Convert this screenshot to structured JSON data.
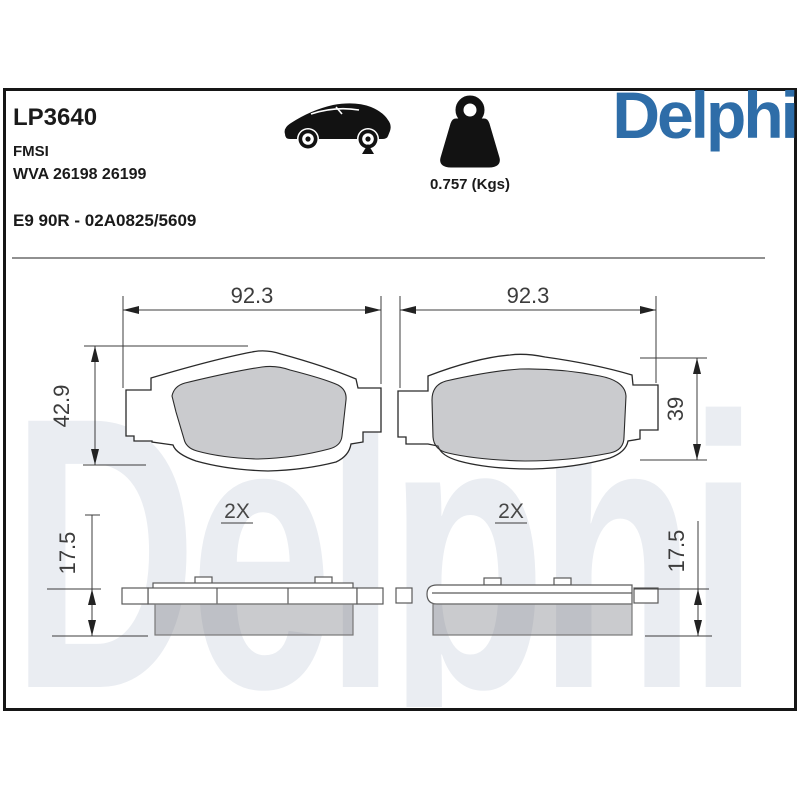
{
  "header": {
    "part_number": "LP3640",
    "fmsi_label": "FMSI",
    "wva_numbers": "WVA 26198 26199",
    "approval": "E9 90R - 02A0825/5609",
    "weight": "0.757 (Kgs)",
    "brand": "Delphi"
  },
  "watermark": "Delphi",
  "dimensions": {
    "pad1_width": "92.3",
    "pad1_height": "42.9",
    "pad1_qty": "2X",
    "pad1_thickness": "17.5",
    "pad2_width": "92.3",
    "pad2_height": "39",
    "pad2_qty": "2X",
    "pad2_thickness": "17.5"
  },
  "icons": {
    "car": "car-rear-axle-icon",
    "weight": "weight-kettlebell-icon"
  },
  "colors": {
    "brand_blue": "#2E6DA8",
    "outline_dark": "#2a2a2a",
    "dimension_gray": "#3c3c3c",
    "friction_gray": "#c9c9c9",
    "watermark_gray": "#eaedf2",
    "frame_black": "#161616"
  }
}
